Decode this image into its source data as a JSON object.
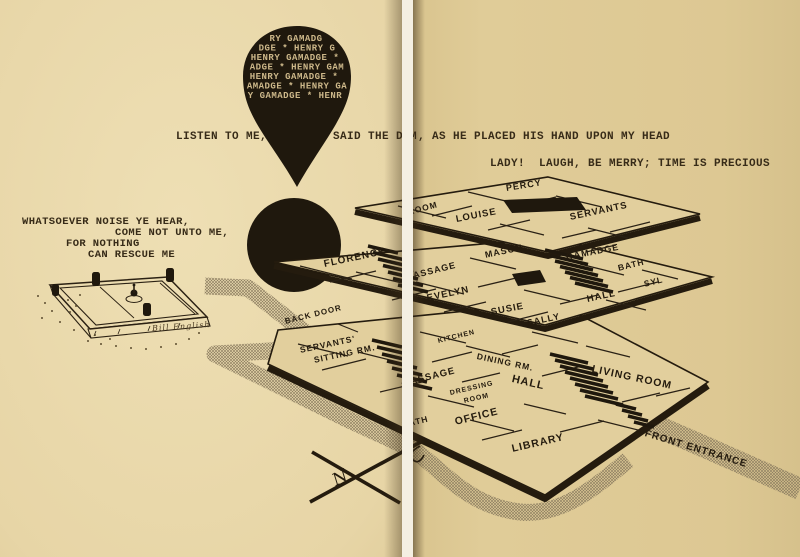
{
  "illustration": {
    "balloon_lines": [
      "RY GAMADG",
      "DGE * HENRY G",
      "HENRY GAMADGE *",
      "ADGE * HENRY GAM",
      "HENRY GAMADGE *",
      "AMADGE * HENRY GA",
      "Y GAMADGE * HENR"
    ],
    "quotes": {
      "listen_left": "LISTEN TO ME,",
      "listen_mid": "SAID THE DEM",
      "listen_right": ", AS HE PLACED HIS HAND UPON MY HEAD",
      "lady": "LADY!  LAUGH, BE MERRY; TIME IS PRECIOUS",
      "noise": [
        "WHATSOEVER NOISE YE HEAR,",
        "COME NOT UNTO ME,",
        "FOR NOTHING",
        "CAN RESCUE ME"
      ]
    },
    "floors": {
      "top": {
        "percy": "PERCY",
        "room": "ROOM",
        "louise": "LOUISE",
        "servants": "SERVANTS"
      },
      "second": {
        "florence": "FLORENCE",
        "passage": "PASSAGE",
        "mason": "MASON",
        "gamadge": "GAMADGE",
        "bath": "BATH",
        "syl": "SYL",
        "evelyn": "EVELYN",
        "susie": "SUSIE",
        "sally": "SALLY",
        "hall": "HALL"
      },
      "ground": {
        "back_door": "BACK DOOR",
        "servants_sitting_1": "SERVANTS'",
        "servants_sitting_2": "SITTING RM.",
        "kitchen": "KITCHEN",
        "dining_rm": "DINING RM.",
        "passage": "PASSAGE",
        "dressing_1": "DRESSING",
        "dressing_2": "ROOM",
        "hall": "HALL",
        "living_room": "LIVING ROOM",
        "bath": "BATH",
        "office": "OFFICE",
        "library": "LIBRARY"
      },
      "site": {
        "front_entrance": "FRONT ENTRANCE"
      }
    },
    "compass_letter": "N",
    "signature": "Bill English"
  },
  "colors": {
    "page_left": "#ecdcae",
    "page_right": "#ddc893",
    "ink": "#241b0e",
    "typewriter_ink": "#372b18",
    "balloon_fill": "#1f180d",
    "balloon_text": "#cdb88a",
    "path_stipple": "#8d7e61",
    "floor_fill": "#e2cf9d"
  }
}
